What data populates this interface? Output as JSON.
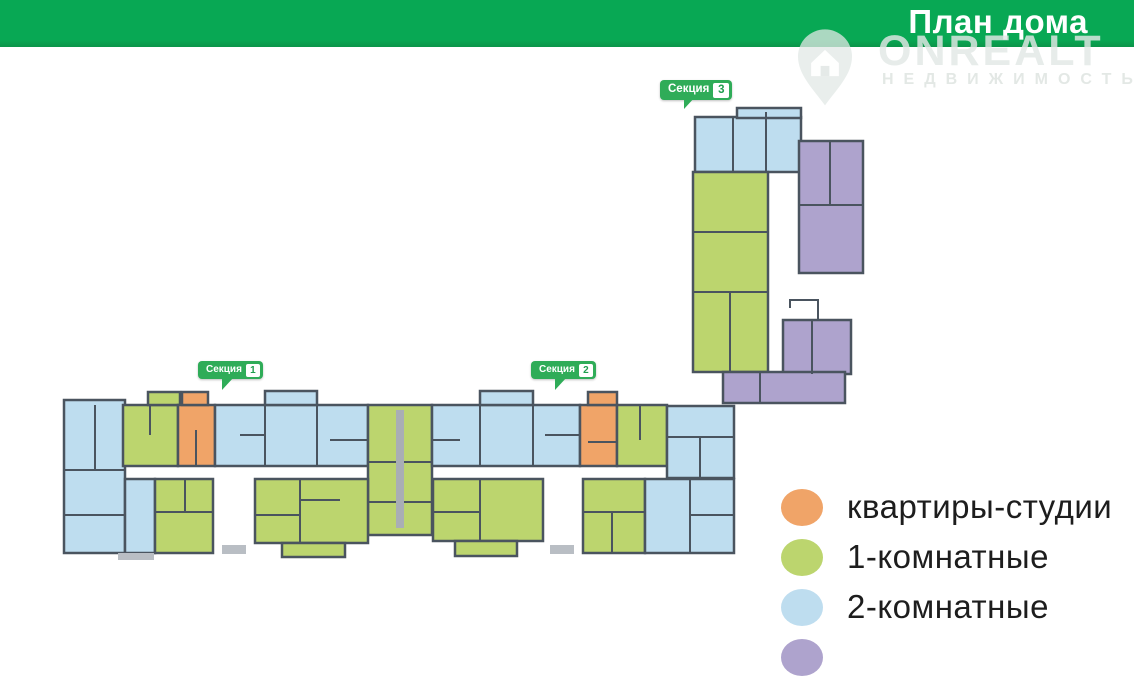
{
  "header": {
    "title": "План дома",
    "bg_color": "#08A854",
    "text_color": "#ffffff"
  },
  "watermark": {
    "brand": "ONREALT",
    "subtitle": "НЕДВИЖИМОСТЬ",
    "icon": "house-pin-icon"
  },
  "sections": [
    {
      "label": "Секция",
      "number": "1",
      "x": 198,
      "y": 361,
      "large": false
    },
    {
      "label": "Секция",
      "number": "2",
      "x": 531,
      "y": 361,
      "large": false
    },
    {
      "label": "Секция",
      "number": "3",
      "x": 660,
      "y": 80,
      "large": true
    }
  ],
  "legend": {
    "items": [
      {
        "label": "квартиры-студии",
        "color": "#F0A468",
        "type": "studio"
      },
      {
        "label": "1-комнатные",
        "color": "#BCD56E",
        "type": "room1"
      },
      {
        "label": "2-комнатные",
        "color": "#BEDDEF",
        "type": "room2"
      },
      {
        "label": "",
        "color": "#AEA3CD",
        "type": "room3"
      }
    ]
  },
  "palette": {
    "studio": "#F0A468",
    "room1": "#BCD56E",
    "room2": "#BEDDEF",
    "room3": "#AEA3CD",
    "wall": "#4A545F",
    "shaft": "#A9AEB5",
    "stub": "#B9BEC4"
  },
  "plan": {
    "units": [
      {
        "t": "room2",
        "x": 695,
        "y": 117,
        "w": 106,
        "h": 55
      },
      {
        "t": "room2",
        "x": 737,
        "y": 108,
        "w": 64,
        "h": 10
      },
      {
        "t": "room3",
        "x": 799,
        "y": 141,
        "w": 64,
        "h": 132
      },
      {
        "t": "room1",
        "x": 693,
        "y": 172,
        "w": 75,
        "h": 200
      },
      {
        "t": "room3",
        "x": 783,
        "y": 320,
        "w": 68,
        "h": 54
      },
      {
        "t": "room3",
        "x": 723,
        "y": 372,
        "w": 122,
        "h": 31
      },
      {
        "t": "room2",
        "x": 64,
        "y": 400,
        "w": 61,
        "h": 153
      },
      {
        "t": "room1",
        "x": 123,
        "y": 405,
        "w": 55,
        "h": 61
      },
      {
        "t": "room1",
        "x": 148,
        "y": 392,
        "w": 32,
        "h": 13
      },
      {
        "t": "studio",
        "x": 178,
        "y": 405,
        "w": 37,
        "h": 61
      },
      {
        "t": "studio",
        "x": 182,
        "y": 392,
        "w": 26,
        "h": 13
      },
      {
        "t": "room2",
        "x": 215,
        "y": 405,
        "w": 153,
        "h": 61
      },
      {
        "t": "room2",
        "x": 265,
        "y": 391,
        "w": 52,
        "h": 14
      },
      {
        "t": "room1",
        "x": 368,
        "y": 405,
        "w": 64,
        "h": 130
      },
      {
        "t": "room2",
        "x": 432,
        "y": 405,
        "w": 148,
        "h": 61
      },
      {
        "t": "room2",
        "x": 480,
        "y": 391,
        "w": 53,
        "h": 14
      },
      {
        "t": "studio",
        "x": 580,
        "y": 405,
        "w": 37,
        "h": 61
      },
      {
        "t": "studio",
        "x": 588,
        "y": 392,
        "w": 29,
        "h": 13
      },
      {
        "t": "room1",
        "x": 617,
        "y": 405,
        "w": 50,
        "h": 61
      },
      {
        "t": "room2",
        "x": 667,
        "y": 406,
        "w": 67,
        "h": 72
      },
      {
        "t": "room2",
        "x": 125,
        "y": 479,
        "w": 30,
        "h": 74
      },
      {
        "t": "room1",
        "x": 155,
        "y": 479,
        "w": 58,
        "h": 74
      },
      {
        "t": "room1",
        "x": 255,
        "y": 479,
        "w": 113,
        "h": 64
      },
      {
        "t": "room1",
        "x": 282,
        "y": 543,
        "w": 63,
        "h": 14
      },
      {
        "t": "room1",
        "x": 433,
        "y": 479,
        "w": 110,
        "h": 62
      },
      {
        "t": "room1",
        "x": 455,
        "y": 541,
        "w": 62,
        "h": 15
      },
      {
        "t": "room1",
        "x": 583,
        "y": 479,
        "w": 62,
        "h": 74
      },
      {
        "t": "room2",
        "x": 645,
        "y": 479,
        "w": 89,
        "h": 74
      }
    ]
  }
}
